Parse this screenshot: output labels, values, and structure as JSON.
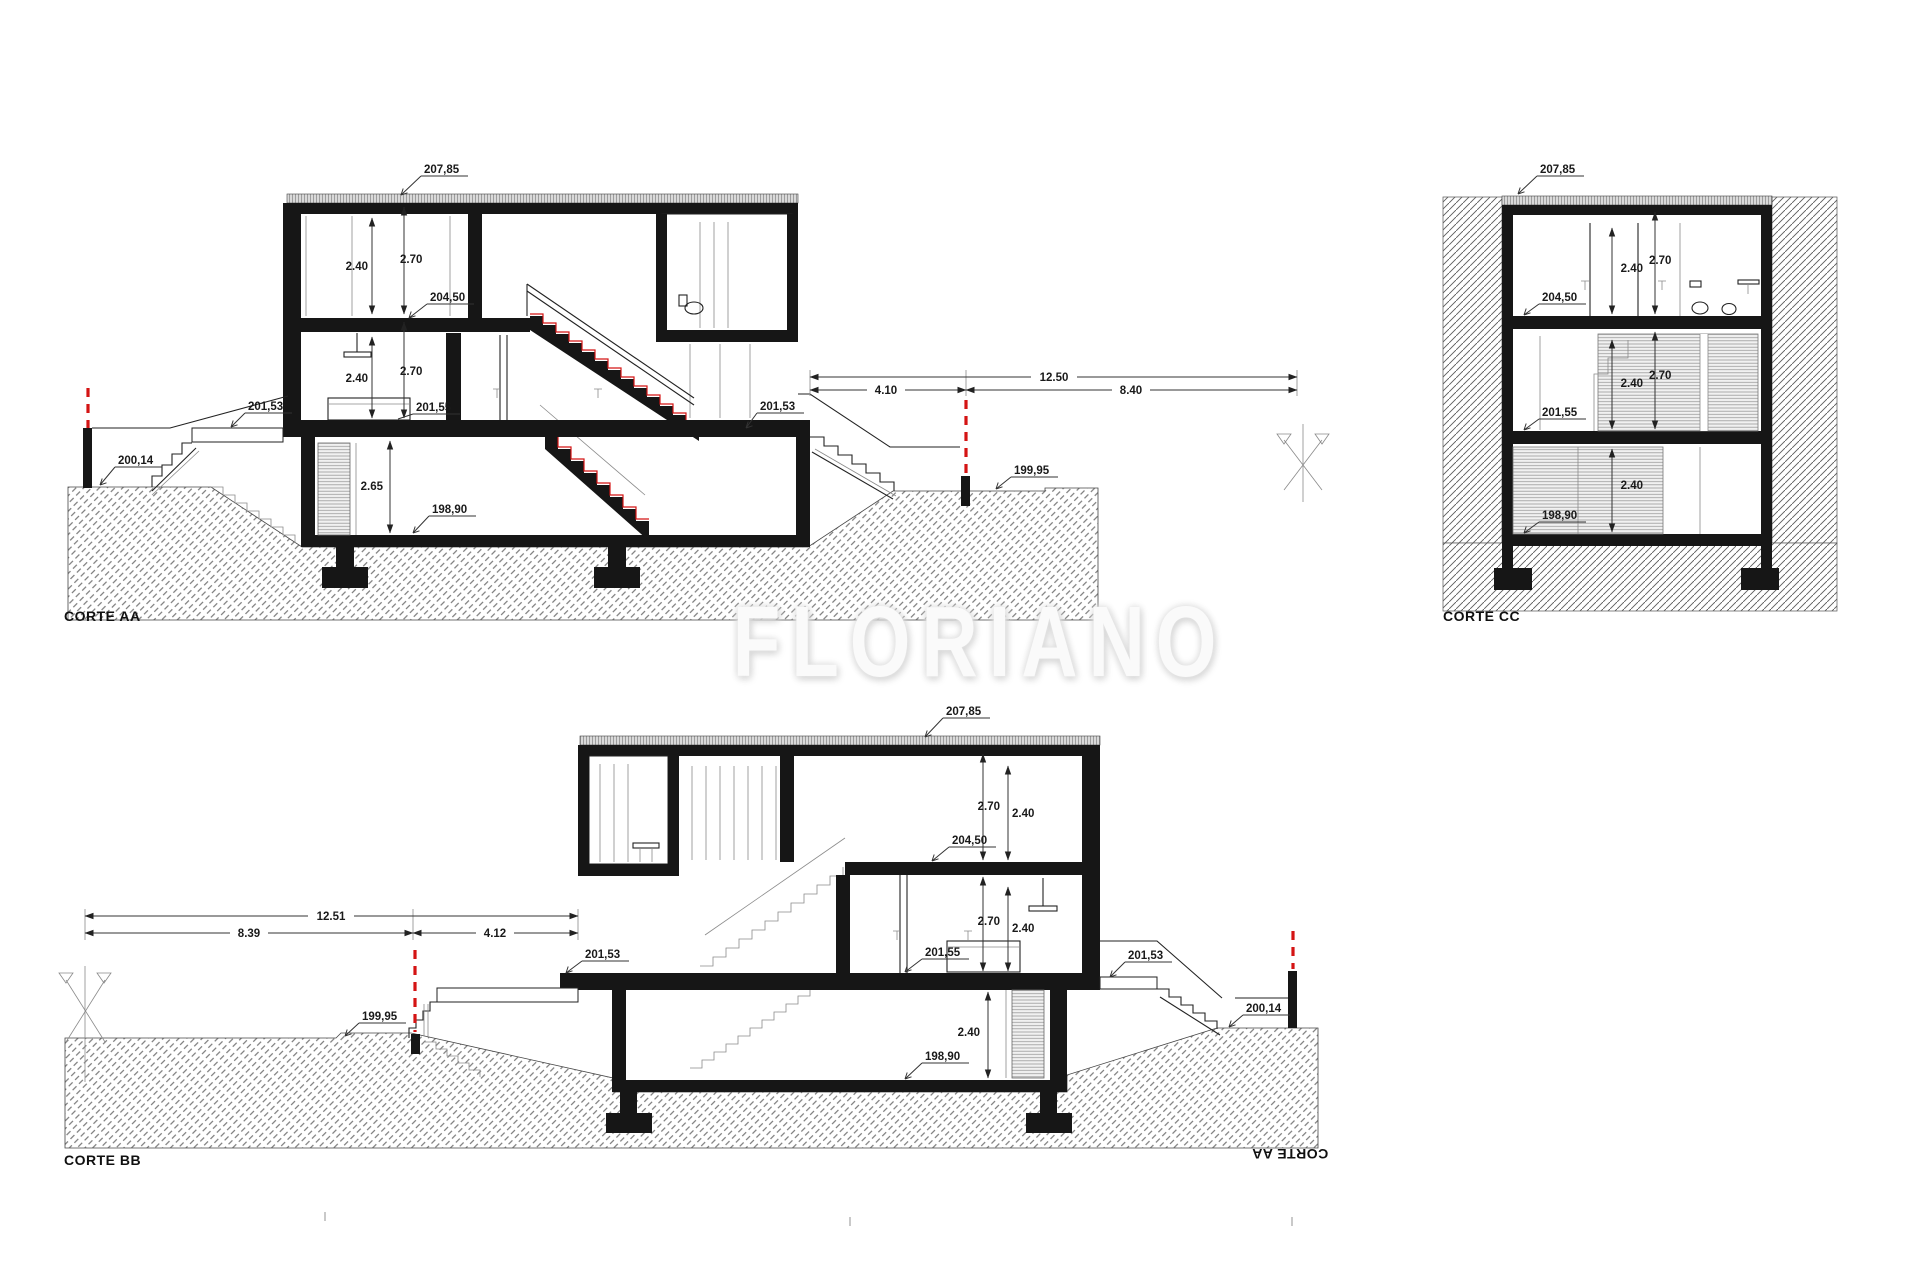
{
  "watermark": "FLORIANO",
  "corte_aa": {
    "title": "CORTE AA",
    "levels": {
      "roof": "207,85",
      "upper": "204,50",
      "terrace_left": "201,53",
      "main": "201,55",
      "terrace_right": "201,53",
      "ground_left": "200,14",
      "ground_right": "199,95",
      "basement": "198,90"
    },
    "heights": {
      "upper_clear": "2.40",
      "upper_total": "2.70",
      "main_clear": "2.40",
      "main_total": "2.70",
      "basement": "2.65"
    },
    "dimensions": {
      "total": "12.50",
      "wall_to_boundary": "4.10",
      "boundary_to_end": "8.40"
    }
  },
  "corte_bb": {
    "title": "CORTE BB",
    "mirrored_title": "CORTE AA",
    "levels": {
      "roof": "207,85",
      "upper": "204,50",
      "main": "201,55",
      "terrace_left": "201,53",
      "terrace_right": "201,53",
      "ground_left": "199,95",
      "ground_right": "200,14",
      "basement": "198,90"
    },
    "heights": {
      "upper_total": "2.70",
      "upper_clear": "2.40",
      "main_total": "2.70",
      "main_clear": "2.40",
      "basement": "2.40"
    },
    "dimensions": {
      "total": "12.51",
      "end_to_boundary": "8.39",
      "boundary_to_wall": "4.12"
    }
  },
  "corte_cc": {
    "title": "CORTE CC",
    "levels": {
      "roof": "207,85",
      "upper": "204,50",
      "main": "201,55",
      "basement": "198,90"
    },
    "heights": {
      "top_clear": "2.40",
      "top_total": "2.70",
      "mid_clear": "2.40",
      "mid_total": "2.70",
      "lower": "2.40"
    }
  }
}
